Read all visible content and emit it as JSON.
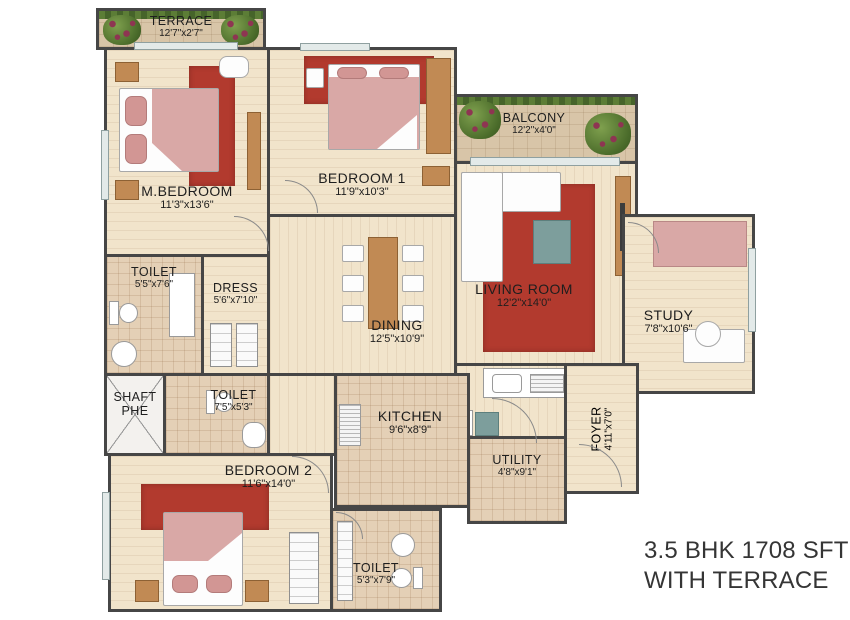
{
  "caption": {
    "line1": "3.5 BHK 1708 SFT",
    "line2": "WITH TERRACE"
  },
  "rooms": {
    "terrace": {
      "name": "TERRACE",
      "dims": "12'7\"x2'7\""
    },
    "m_bedroom": {
      "name": "M.BEDROOM",
      "dims": "11'3\"x13'6\""
    },
    "bedroom1": {
      "name": "BEDROOM 1",
      "dims": "11'9\"x10'3\""
    },
    "balcony": {
      "name": "BALCONY",
      "dims": "12'2\"x4'0\""
    },
    "living_room": {
      "name": "LIVING ROOM",
      "dims": "12'2\"x14'0\""
    },
    "study": {
      "name": "STUDY",
      "dims": "7'8\"x10'6\""
    },
    "toilet_master": {
      "name": "TOILET",
      "dims": "5'5\"x7'6\""
    },
    "dress": {
      "name": "DRESS",
      "dims": "5'6\"x7'10\""
    },
    "dining": {
      "name": "DINING",
      "dims": "12'5\"x10'9\""
    },
    "shaft": {
      "name": "SHAFT",
      "dims": "PHE"
    },
    "toilet_common": {
      "name": "TOILET",
      "dims": "7'5\"x5'3\""
    },
    "kitchen": {
      "name": "KITCHEN",
      "dims": "9'6\"x8'9\""
    },
    "utility": {
      "name": "UTILITY",
      "dims": "4'8\"x9'1\""
    },
    "foyer": {
      "name": "FOYER",
      "dims": "4'11\"x7'0\""
    },
    "bedroom2": {
      "name": "BEDROOM 2",
      "dims": "11'6\"x14'0\""
    },
    "toilet_bed2": {
      "name": "TOILET",
      "dims": "5'3\"x7'9\""
    }
  },
  "colors": {
    "wall": "#464646",
    "floor_wood": "#f1e4cb",
    "floor_tile": "#e4d0b6",
    "rug_red": "#b23a2e",
    "bed_pink": "#d9a8a6",
    "furniture_brown": "#c18a54",
    "table_teal": "#7d9e9c",
    "plant_green": "#4a6b2a",
    "caption_text": "#353535"
  }
}
